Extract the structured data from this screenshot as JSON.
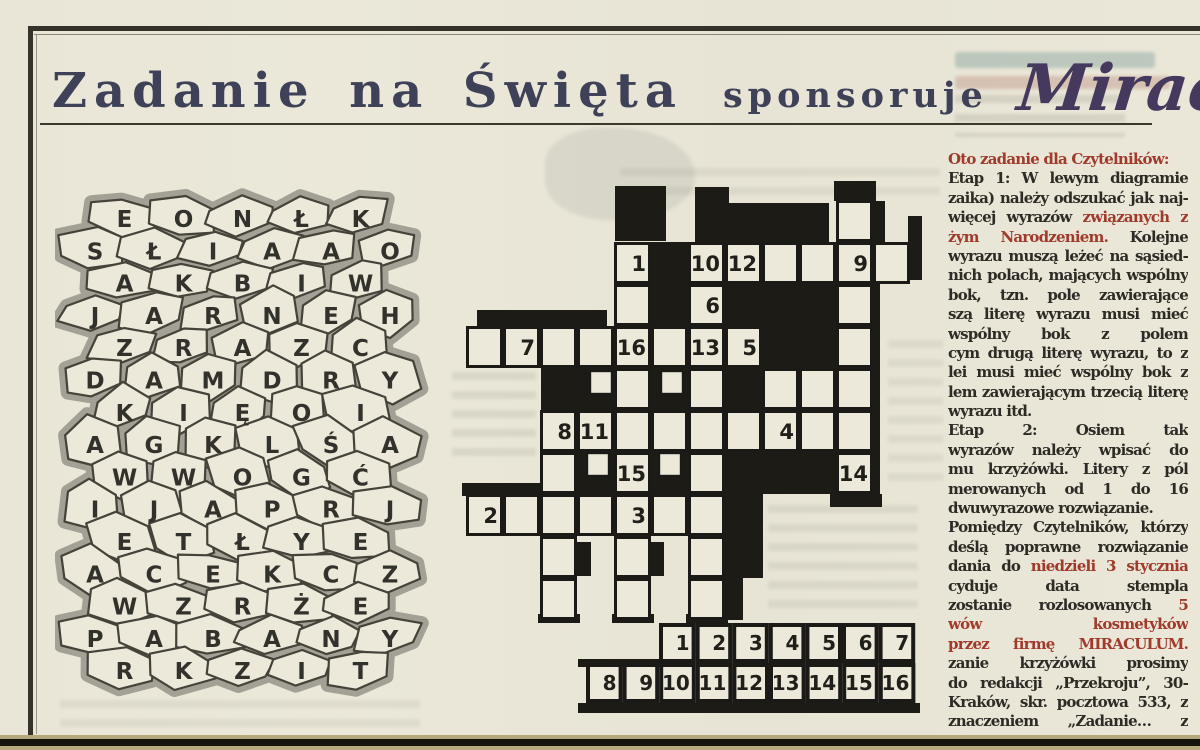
{
  "page": {
    "title_main": "Zadanie na Święta",
    "title_sub": "sponsoruje",
    "title_brand": "Miraculum"
  },
  "colors": {
    "paper": "#e9e6d7",
    "ink": "#2e2b26",
    "red": "#a03a2b",
    "title_navy": "#3e4157",
    "brand_purple": "#46395e",
    "grid_black": "#1d1b16",
    "mosaic_gray": "#a3a096",
    "bottom_tan": "#b5a87a"
  },
  "mosaic": {
    "rows": [
      {
        "letters": [
          "E",
          "O",
          "N",
          "Ł",
          "K"
        ]
      },
      {
        "letters": [
          "S",
          "Ł",
          "I",
          "A",
          "A",
          "O"
        ]
      },
      {
        "letters": [
          "A",
          "K",
          "B",
          "I",
          "W"
        ]
      },
      {
        "letters": [
          "J",
          "A",
          "R",
          "N",
          "E",
          "H"
        ]
      },
      {
        "letters": [
          "Z",
          "R",
          "A",
          "Z",
          "C"
        ]
      },
      {
        "letters": [
          "D",
          "A",
          "M",
          "D",
          "R",
          "Y"
        ]
      },
      {
        "letters": [
          "K",
          "I",
          "Ę",
          "O",
          "I"
        ]
      },
      {
        "letters": [
          "A",
          "G",
          "K",
          "L",
          "Ś",
          "A"
        ]
      },
      {
        "letters": [
          "W",
          "W",
          "O",
          "G",
          "Ć"
        ]
      },
      {
        "letters": [
          "I",
          "J",
          "A",
          "P",
          "R",
          "J"
        ]
      },
      {
        "letters": [
          "E",
          "T",
          "Ł",
          "Y",
          "E"
        ]
      },
      {
        "letters": [
          "A",
          "C",
          "E",
          "K",
          "C",
          "Z"
        ]
      },
      {
        "letters": [
          "W",
          "Z",
          "R",
          "Ż",
          "E"
        ]
      },
      {
        "letters": [
          "P",
          "A",
          "B",
          "A",
          "N",
          "Y"
        ]
      },
      {
        "letters": [
          "R",
          "K",
          "Z",
          "I",
          "T"
        ]
      }
    ]
  },
  "crossword": {
    "cell_w": 37,
    "cell_h": 42,
    "origin_x": 16,
    "origin_y": 25,
    "white_cells": [
      {
        "c": 10,
        "r": 0
      },
      {
        "c": 4,
        "r": 1,
        "n": "1"
      },
      {
        "c": 6,
        "r": 1,
        "n": "10"
      },
      {
        "c": 7,
        "r": 1,
        "n": "12"
      },
      {
        "c": 8,
        "r": 1
      },
      {
        "c": 9,
        "r": 1
      },
      {
        "c": 10,
        "r": 1,
        "n": "9"
      },
      {
        "c": 11,
        "r": 1
      },
      {
        "c": 4,
        "r": 2
      },
      {
        "c": 6,
        "r": 2,
        "n": "6"
      },
      {
        "c": 10,
        "r": 2
      },
      {
        "c": 0,
        "r": 3
      },
      {
        "c": 1,
        "r": 3,
        "n": "7"
      },
      {
        "c": 2,
        "r": 3
      },
      {
        "c": 3,
        "r": 3
      },
      {
        "c": 4,
        "r": 3,
        "n": "16"
      },
      {
        "c": 5,
        "r": 3
      },
      {
        "c": 6,
        "r": 3,
        "n": "13"
      },
      {
        "c": 7,
        "r": 3,
        "n": "5"
      },
      {
        "c": 10,
        "r": 3
      },
      {
        "c": 4,
        "r": 4
      },
      {
        "c": 6,
        "r": 4
      },
      {
        "c": 8,
        "r": 4
      },
      {
        "c": 9,
        "r": 4
      },
      {
        "c": 10,
        "r": 4
      },
      {
        "c": 2,
        "r": 5,
        "n": "8"
      },
      {
        "c": 3,
        "r": 5,
        "n": "11"
      },
      {
        "c": 4,
        "r": 5
      },
      {
        "c": 5,
        "r": 5
      },
      {
        "c": 6,
        "r": 5
      },
      {
        "c": 7,
        "r": 5
      },
      {
        "c": 8,
        "r": 5,
        "n": "4"
      },
      {
        "c": 9,
        "r": 5
      },
      {
        "c": 10,
        "r": 5
      },
      {
        "c": 2,
        "r": 6
      },
      {
        "c": 4,
        "r": 6,
        "n": "15"
      },
      {
        "c": 6,
        "r": 6
      },
      {
        "c": 10,
        "r": 6,
        "n": "14"
      },
      {
        "c": 0,
        "r": 7,
        "n": "2"
      },
      {
        "c": 1,
        "r": 7
      },
      {
        "c": 2,
        "r": 7
      },
      {
        "c": 3,
        "r": 7
      },
      {
        "c": 4,
        "r": 7,
        "n": "3"
      },
      {
        "c": 5,
        "r": 7
      },
      {
        "c": 6,
        "r": 7
      },
      {
        "c": 2,
        "r": 8
      },
      {
        "c": 4,
        "r": 8
      },
      {
        "c": 6,
        "r": 8
      },
      {
        "c": 2,
        "r": 9
      },
      {
        "c": 4,
        "r": 9
      },
      {
        "c": 6,
        "r": 9
      }
    ],
    "half_cells": [
      [
        140,
        196,
        22,
        23
      ],
      [
        211,
        196,
        22,
        23
      ],
      [
        137,
        278,
        22,
        23
      ],
      [
        209,
        278,
        22,
        23
      ]
    ],
    "black_regions": [
      [
        165,
        11,
        51,
        55
      ],
      [
        245,
        28,
        134,
        39
      ],
      [
        245,
        12,
        34,
        16
      ],
      [
        384,
        6,
        42,
        20
      ],
      [
        423,
        26,
        12,
        41
      ],
      [
        458,
        41,
        14,
        64
      ],
      [
        201,
        67,
        38,
        84
      ],
      [
        275,
        109,
        111,
        42
      ],
      [
        409,
        109,
        21,
        214
      ],
      [
        27,
        135,
        130,
        16
      ],
      [
        312,
        151,
        75,
        42
      ],
      [
        91,
        193,
        74,
        44
      ],
      [
        201,
        193,
        38,
        44
      ],
      [
        275,
        193,
        38,
        44
      ],
      [
        127,
        277,
        38,
        42
      ],
      [
        201,
        277,
        38,
        42
      ],
      [
        275,
        277,
        111,
        42
      ],
      [
        12,
        308,
        78,
        13
      ],
      [
        275,
        319,
        38,
        84
      ],
      [
        275,
        403,
        18,
        42
      ],
      [
        127,
        367,
        14,
        34
      ],
      [
        201,
        367,
        13,
        34
      ],
      [
        88,
        439,
        42,
        9
      ],
      [
        162,
        439,
        42,
        9
      ],
      [
        236,
        439,
        42,
        9
      ],
      [
        380,
        319,
        52,
        13
      ]
    ],
    "answer_strip": {
      "row1": [
        "1",
        "2",
        "3",
        "4",
        "5",
        "6",
        "7"
      ],
      "row2": [
        "8",
        "9",
        "10",
        "11",
        "12",
        "13",
        "14",
        "15",
        "16"
      ],
      "row1_x": 209,
      "row1_y": 448,
      "row2_x": 136,
      "row2_y": 488,
      "cell_w": 36.6,
      "cell_h": 40,
      "bars": [
        [
          128,
          484,
          82,
          8
        ],
        [
          128,
          528,
          342,
          10
        ]
      ]
    }
  },
  "instructions": {
    "lines": [
      {
        "end": true,
        "runs": [
          {
            "t": "Oto zadanie dla Czytelników:",
            "red": true
          }
        ]
      },
      {
        "runs": [
          {
            "t": "Etap 1: W lewym diagramie (mo-"
          }
        ]
      },
      {
        "runs": [
          {
            "t": "zaika) należy odszukać jak naj-"
          }
        ]
      },
      {
        "runs": [
          {
            "t": "więcej wyrazów "
          },
          {
            "t": "związanych z Bo-",
            "red": true
          }
        ]
      },
      {
        "runs": [
          {
            "t": "żym Narodzeniem.",
            "red": true
          },
          {
            "t": " Kolejne litery"
          }
        ]
      },
      {
        "runs": [
          {
            "t": "wyrazu muszą leżeć na sąsied-"
          }
        ]
      },
      {
        "runs": [
          {
            "t": "nich polach, mających wspólny"
          }
        ]
      },
      {
        "runs": [
          {
            "t": "bok, tzn. pole zawierające pierw-"
          }
        ]
      },
      {
        "runs": [
          {
            "t": "szą literę wyrazu musi mieć"
          }
        ]
      },
      {
        "runs": [
          {
            "t": "wspólny bok z polem zawierają-"
          }
        ]
      },
      {
        "runs": [
          {
            "t": "cym drugą literę wyrazu, to z ko-"
          }
        ]
      },
      {
        "runs": [
          {
            "t": "lei musi mieć wspólny bok z po-"
          }
        ]
      },
      {
        "runs": [
          {
            "t": "lem zawierającym trzecią literę"
          }
        ]
      },
      {
        "end": true,
        "runs": [
          {
            "t": "wyrazu itd."
          }
        ]
      },
      {
        "runs": [
          {
            "t": "Etap 2: Osiem tak wyszukanych"
          }
        ]
      },
      {
        "runs": [
          {
            "t": "wyrazów należy wpisać do diagra-"
          }
        ]
      },
      {
        "runs": [
          {
            "t": "mu krzyżówki. Litery z pól ponu-"
          }
        ]
      },
      {
        "runs": [
          {
            "t": "merowanych od 1 do 16 utworzą"
          }
        ]
      },
      {
        "end": true,
        "runs": [
          {
            "t": "dwuwyrazowe rozwiązanie."
          }
        ]
      },
      {
        "runs": [
          {
            "t": "Pomiędzy Czytelników, którzy na-"
          }
        ]
      },
      {
        "runs": [
          {
            "t": "deślą poprawne rozwiązanie za-"
          }
        ]
      },
      {
        "runs": [
          {
            "t": "dania do "
          },
          {
            "t": "niedzieli 3 stycznia",
            "red": true
          },
          {
            "t": " (de-"
          }
        ]
      },
      {
        "runs": [
          {
            "t": "cyduje data stempla pocztowego),"
          }
        ]
      },
      {
        "runs": [
          {
            "t": "zostanie rozlosowanych "
          },
          {
            "t": "5 zesta-",
            "red": true
          }
        ]
      },
      {
        "runs": [
          {
            "t": "wów kosmetyków ufundowanych",
            "red": true
          }
        ]
      },
      {
        "runs": [
          {
            "t": "przez firmę MIRACULUM.",
            "red": true
          },
          {
            "t": " Rozwią-"
          }
        ]
      },
      {
        "runs": [
          {
            "t": "zanie krzyżówki prosimy nadsyłać"
          }
        ]
      },
      {
        "runs": [
          {
            "t": "do redakcji „Przekroju”, 30-960"
          }
        ]
      },
      {
        "runs": [
          {
            "t": "Kraków, skr. pocztowa 533, z za-"
          }
        ]
      },
      {
        "runs": [
          {
            "t": "znaczeniem „Zadanie… z MIRA-"
          }
        ]
      },
      {
        "end": true,
        "runs": [
          {
            "t": "CULUM”."
          }
        ]
      }
    ]
  }
}
